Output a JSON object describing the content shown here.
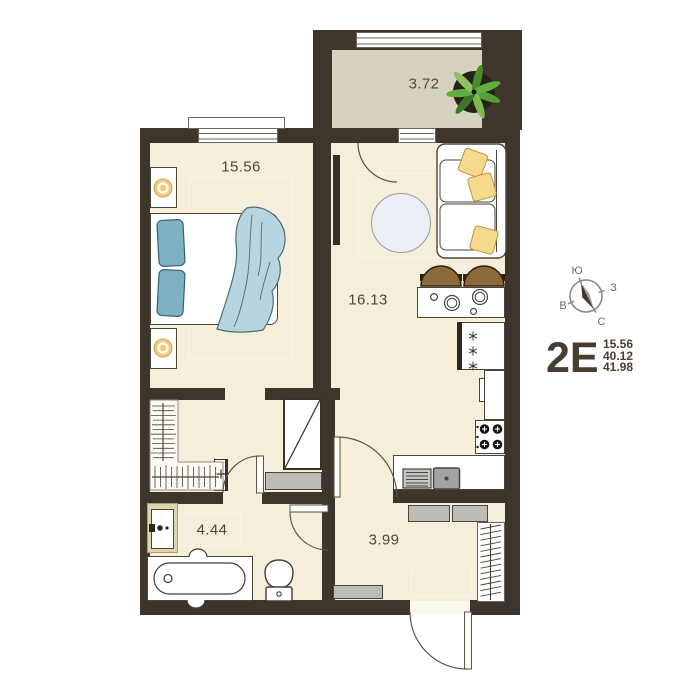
{
  "plan": {
    "code": "2E",
    "stats": [
      "15.56",
      "40.12",
      "41.98"
    ]
  },
  "rooms": {
    "bedroom": "15.56",
    "living_kitchen": "16.13",
    "balcony": "3.72",
    "bathroom": "4.44",
    "hallway": "3.99"
  },
  "compass": {
    "top": "Ю",
    "right": "З",
    "left": "В",
    "bottom": "С"
  },
  "colors": {
    "wall": "#3e362d",
    "floor": "#f5eedb",
    "balcony_floor": "#d7d1c0",
    "blue_textile": "#7db2c5",
    "yellow_pillow": "#f7d98e",
    "green_plant": "#529e38",
    "gray_cabinet": "#bcbbb6",
    "text": "#4e463c"
  }
}
